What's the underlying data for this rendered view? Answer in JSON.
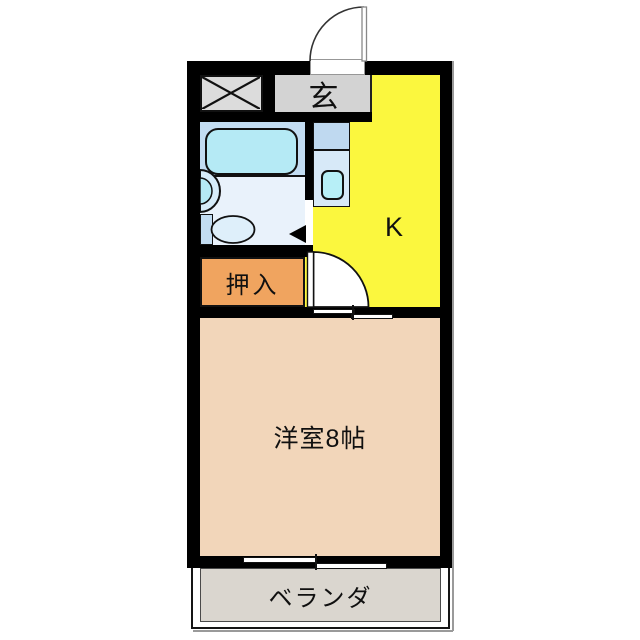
{
  "floorplan": {
    "type": "1K apartment floor plan",
    "rooms": {
      "genkan": {
        "label": "玄"
      },
      "kitchen": {
        "label": "K"
      },
      "closet": {
        "label": "押入"
      },
      "western_room": {
        "label": "洋室8帖"
      },
      "veranda": {
        "label": "ベランダ"
      }
    },
    "fixtures": [
      "bathtub",
      "sink",
      "toilet",
      "kitchen-sink",
      "shaft-cross",
      "entrance-door-swing",
      "kitchen-door-swing",
      "sliding-door",
      "sliding-window"
    ]
  },
  "colors": {
    "wall": "#000000",
    "kitchen": "#FBF73E",
    "genkan": "#D3D3D3",
    "shaft": "#DCDCDC",
    "closet": "#F0A45F",
    "room": "#F2D6BA",
    "veranda": "#DAD6CF",
    "bath_panel": "#C3DDF2",
    "bath_floor": "#E9F2FB",
    "fixture": "#B5EAF5",
    "counter_top": "#BFD9F0",
    "counter_bottom": "#D7E9F8",
    "sink": "#B7EFF7",
    "bowl": "#DEEFFA"
  }
}
